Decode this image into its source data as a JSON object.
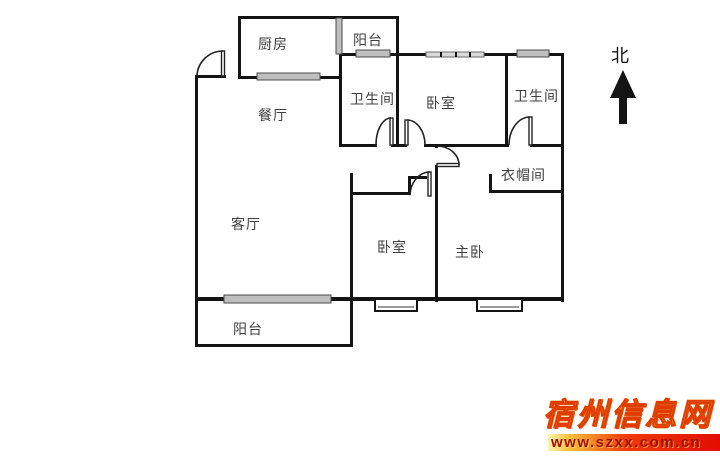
{
  "floorplan": {
    "rooms": {
      "kitchen": "厨房",
      "balcony_top": "阳台",
      "bathroom_1": "卫生间",
      "bedroom_top": "卧室",
      "bathroom_2": "卫生间",
      "dining_room": "餐厅",
      "living_room": "客厅",
      "cloakroom": "衣帽间",
      "bedroom_2": "卧室",
      "master_bedroom": "主卧",
      "balcony_bottom": "阳台"
    },
    "compass": {
      "label": "北"
    },
    "colors": {
      "wall": "#141414",
      "window_fill": "#bfbfbf",
      "window_border": "#4a4a4a",
      "label_text": "#3f3f3f",
      "background": "#ffffff"
    }
  },
  "watermark": {
    "site_name": "宿州信息网",
    "site_url": "www.szxx.com.cn",
    "colors": {
      "title": "#f7a81a",
      "title_outline": "#e03c00",
      "bar_gradient_start": "#fff3b0",
      "bar_gradient_end": "#e20c00",
      "url_text": "#9e1000"
    }
  }
}
